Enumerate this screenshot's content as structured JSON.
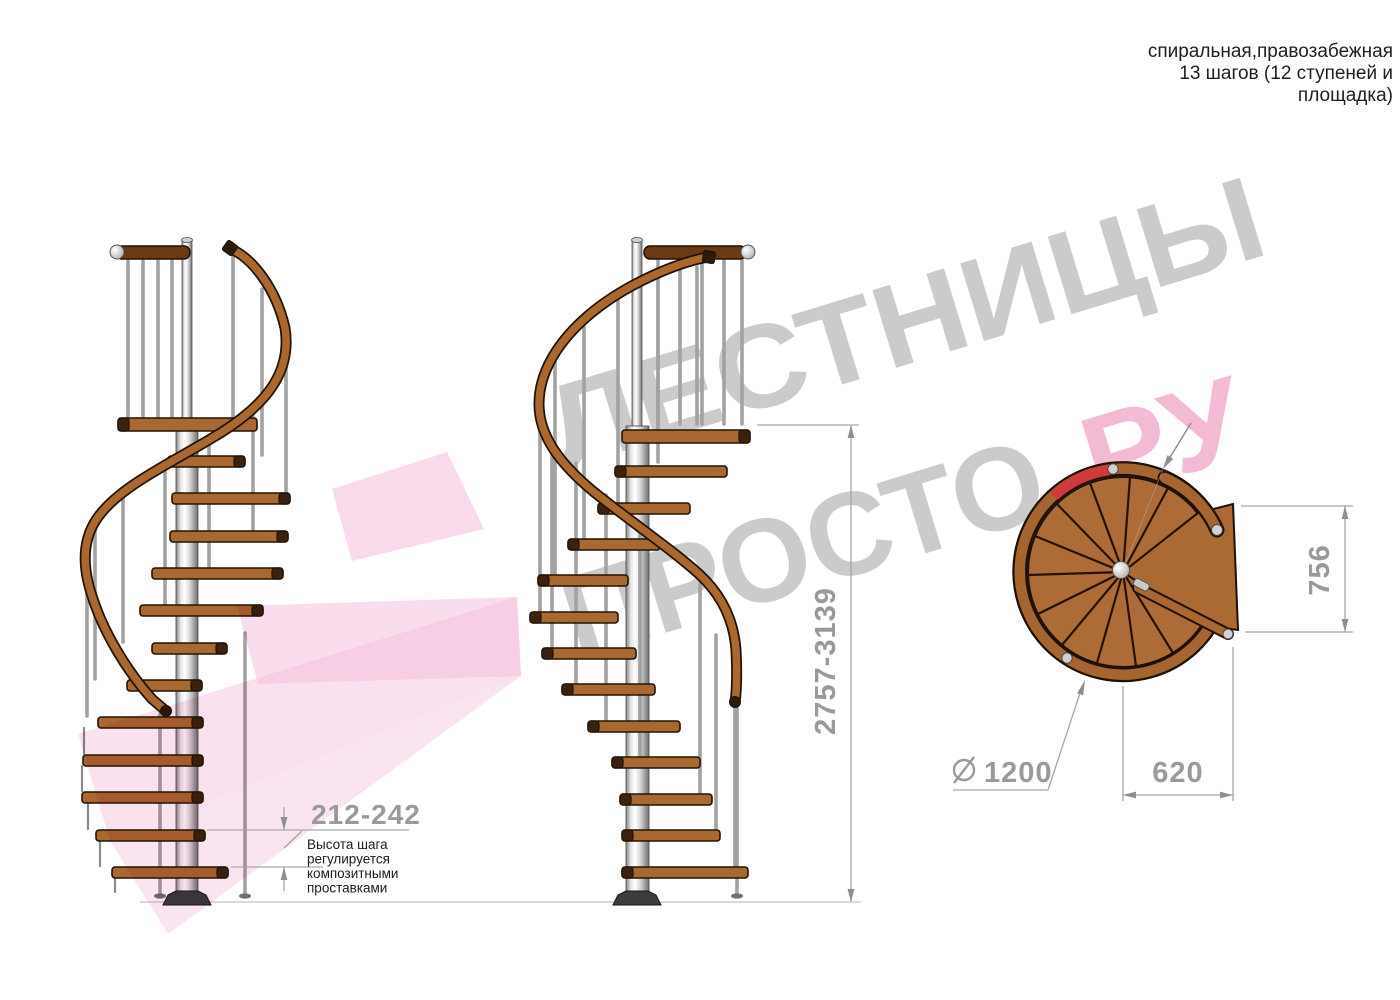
{
  "annotation": {
    "lines": [
      "спиральная,правозабежная",
      "13 шагов (12 ступеней и",
      "площадка)"
    ]
  },
  "watermark": {
    "line1": "ЛЕСТНИЦЫ",
    "line2_gray": "ПРОСТО",
    "line2_pink": ".РУ"
  },
  "dimensions": {
    "total_height": "2757-3139",
    "step_height": "212-242",
    "platform_depth": "756",
    "platform_width": "620",
    "diameter": "1200"
  },
  "note": {
    "lines": [
      "Высота шага",
      "регулируется",
      "композитными",
      "проставками"
    ]
  },
  "colors": {
    "wood": "#a76832",
    "wood_dark": "#3a220e",
    "handrail": "#a8682f",
    "dimension_gray": "#9a9a9a",
    "text_black": "#1c1c1c",
    "watermark_gray": "#c6c6c6",
    "watermark_pink": "#f2b3cf",
    "pink_arrow": "#f3bcd9",
    "red_marker": "#cf3a3c"
  }
}
